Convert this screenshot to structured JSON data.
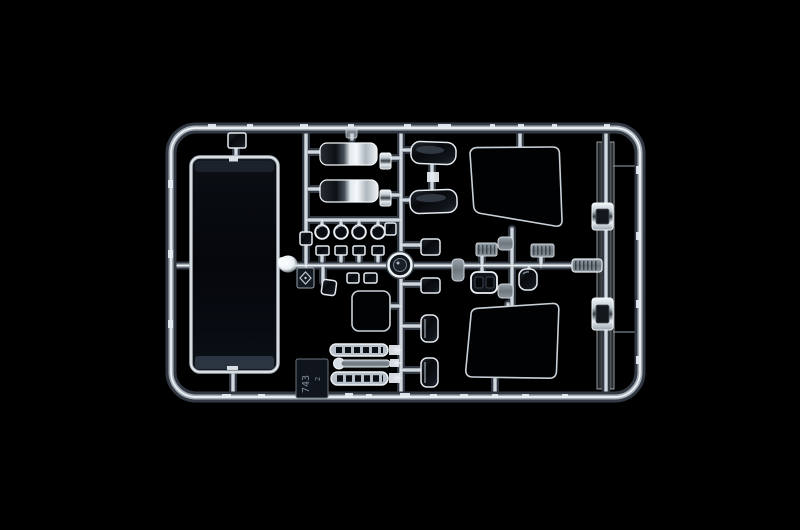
{
  "image": {
    "type": "product-photograph",
    "subject": "transparent plastic model-kit sprue (clear parts tree) lit on a black background"
  },
  "colors": {
    "background": "#000000",
    "frame_core": "#eff4f7",
    "frame_mid": "#a6afb8",
    "window_outline": "#c9d1d8",
    "chrome_highlight": "#f4f7f9",
    "dark_part": "#0b0e13",
    "gate_blob": "#f8fbfd"
  },
  "tag": {
    "primary": "743",
    "secondary": "2"
  },
  "parts": [
    "windshield-pane",
    "top-clip",
    "headlight-lens-chrome-1",
    "headlight-lens-chrome-2",
    "wind-deflector-1",
    "wind-deflector-2",
    "side-window-upper",
    "side-window-lower",
    "round-lens-row",
    "square-lens-row",
    "ring-part",
    "logo-tag",
    "number-tag",
    "small-clear-window",
    "wiper-blade-1",
    "wiper-arm-rod",
    "wiper-blade-2",
    "grille-part-1",
    "grille-part-2",
    "twin-lens-housing",
    "dark-lamp-housing",
    "bracket-1",
    "bracket-2",
    "right-chrome-part-1",
    "right-chrome-part-2",
    "right-clear-strip",
    "ridged-connector",
    "injection-gate-blob"
  ]
}
